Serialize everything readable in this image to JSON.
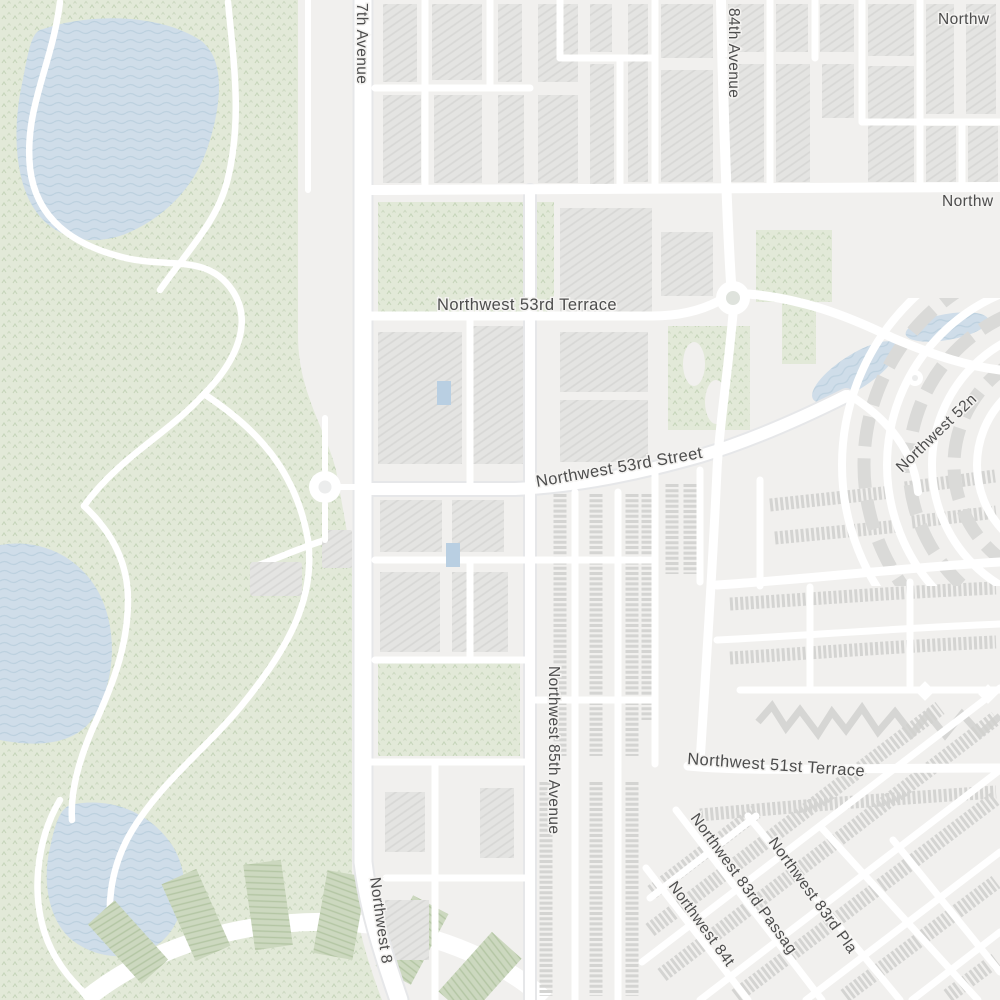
{
  "map": {
    "kind": "street-map-tile",
    "labels": {
      "street_87th_avenue_north": "7th Avenue",
      "street_top_right_truncated": "Northw",
      "street_84th_avenue": "84th Avenue",
      "street_right_truncated": "Northw",
      "street_53rd_terrace": "Northwest 53rd Terrace",
      "street_53rd_street": "Northwest 53rd Street",
      "street_52nd_truncated": "Northwest 52n",
      "street_85th_avenue": "Northwest 85th Avenue",
      "street_51st_terrace": "Northwest 51st Terrace",
      "street_87th_avenue_south": "Northwest 8",
      "street_84th_bottom_truncated": "Northwest 84t",
      "street_83rd_passage": "Northwest 83rd Passag",
      "street_83rd_place_truncated": "Northwest 83rd Pla"
    },
    "colors": {
      "land": "#f1f0ee",
      "park": "#e2e9d8",
      "park_texture": "#c6d5ba",
      "water": "#cfdde9",
      "water_wave": "#bdd1df",
      "road": "#ffffff",
      "road_casing": "#e6e7e9",
      "building": "#e4e4e2",
      "building_hatch": "#d5d5d3",
      "rowhouse": "#d7d7d5",
      "tee_box_green": "#ccd8bf",
      "label_text": "#4d4d4d",
      "label_halo": "#f4f3f1"
    },
    "features": {
      "park_golf_course": "left side with three lakes and winding cart paths",
      "roundabouts": 3,
      "ring_community_ponds": 2,
      "fan_tee_boxes": "bottom-left radial green boxes",
      "diagonal_rowhouse_grid": "bottom-right"
    }
  }
}
